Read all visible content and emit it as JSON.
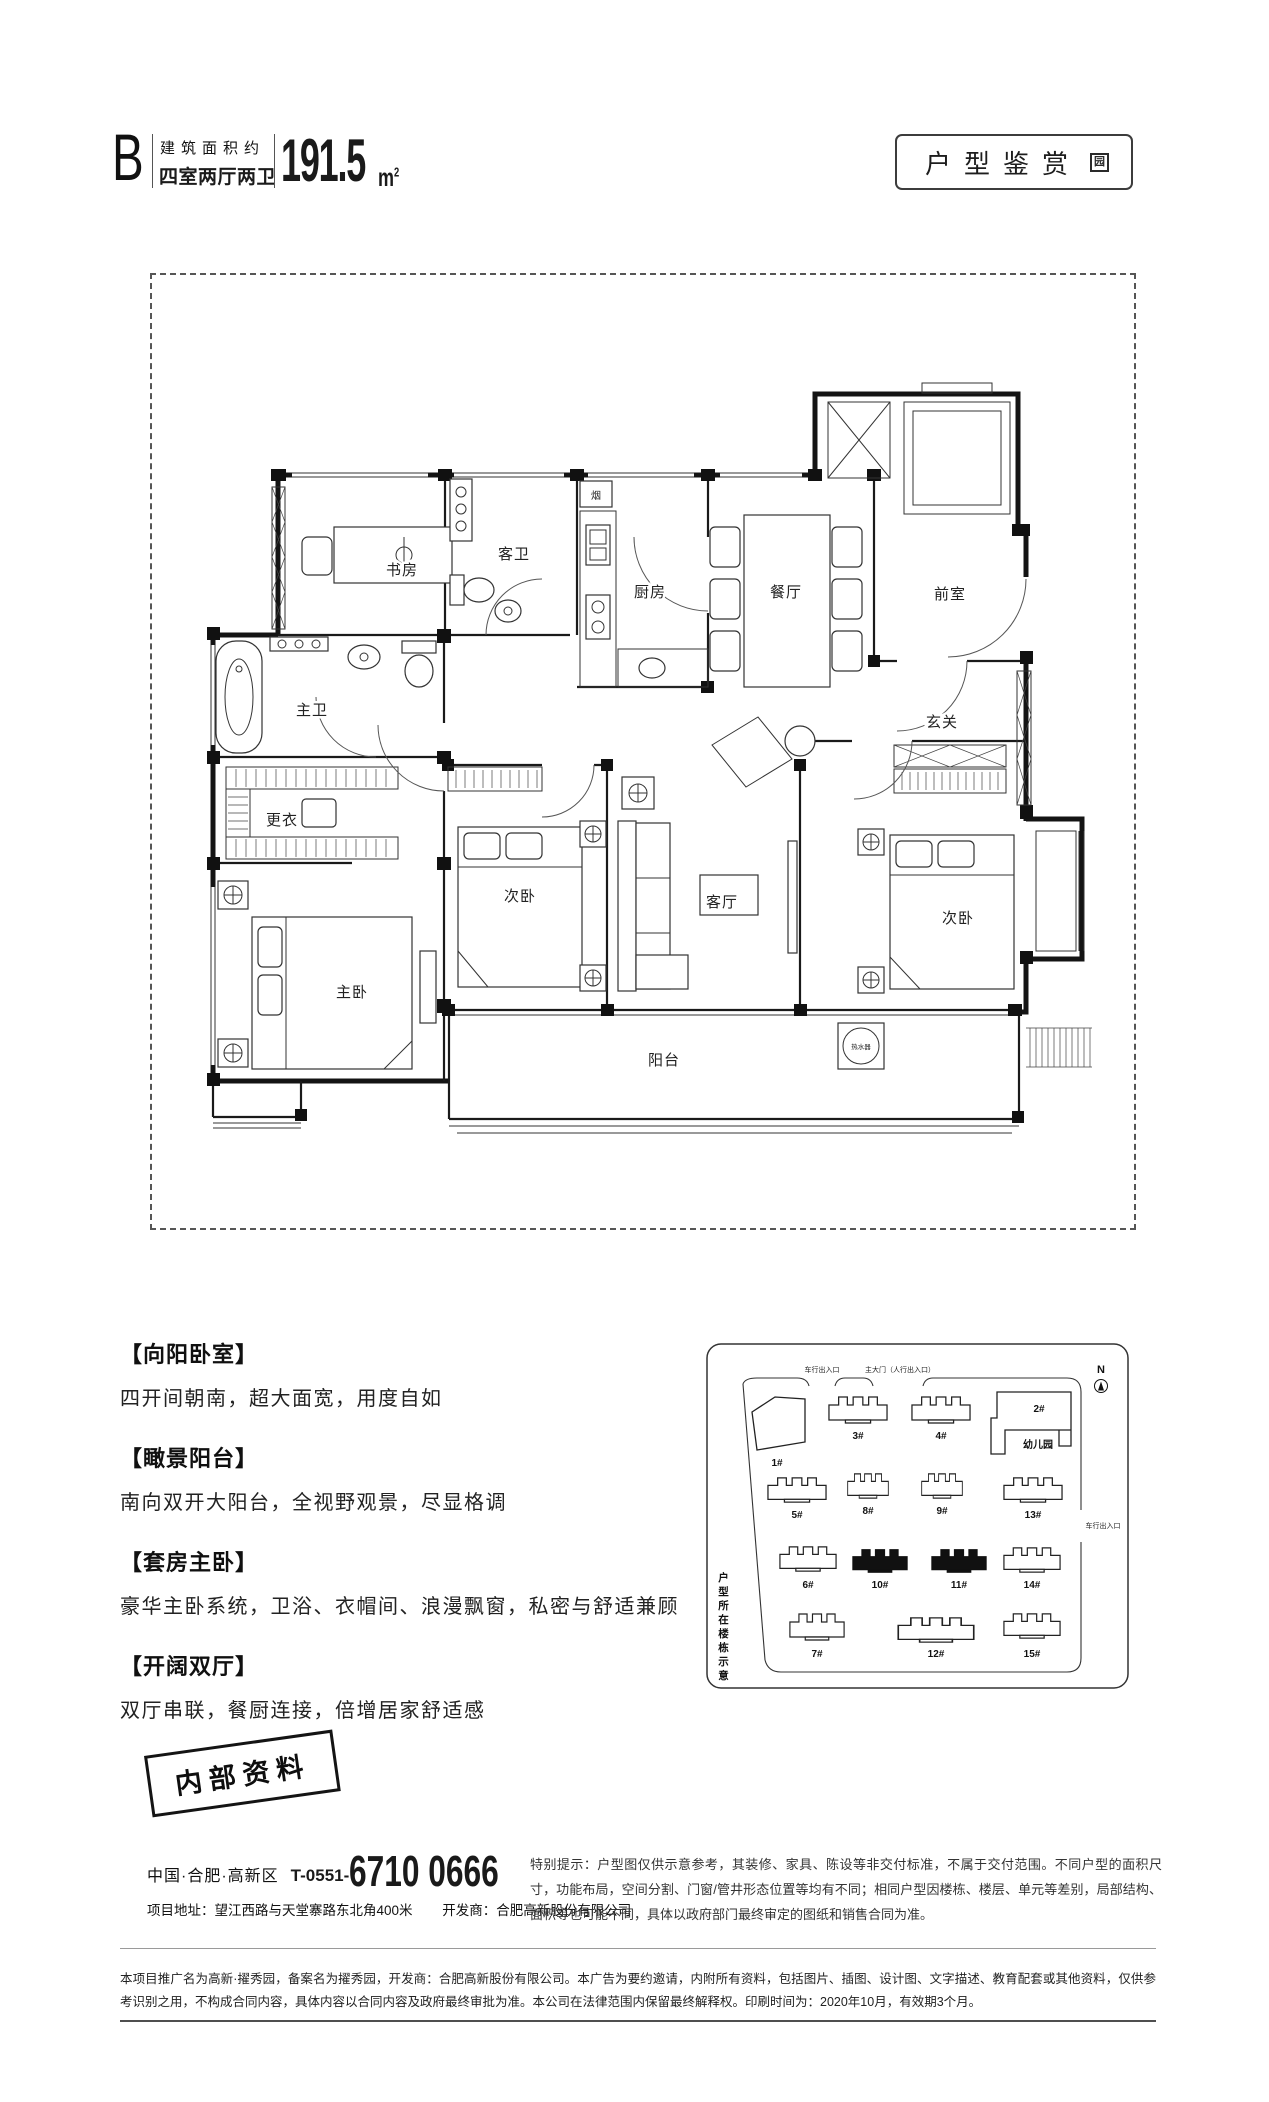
{
  "header": {
    "unit": "B",
    "area_note": "建筑面积约",
    "layout_type": "四室两厅两卫",
    "area_value": "191.5",
    "area_unit": "m",
    "area_sup": "2"
  },
  "badge": {
    "label": "户型鉴赏",
    "seal": "园"
  },
  "floorplan": {
    "rooms": {
      "study": "书房",
      "guest_bath": "客卫",
      "kitchen": "厨房",
      "dining": "餐厅",
      "front_room": "前室",
      "foyer": "玄关",
      "master_bath": "主卫",
      "dressing": "更衣",
      "master_bedroom": "主卧",
      "bedroom_mid": "次卧",
      "living": "客厅",
      "bedroom_right": "次卧",
      "balcony": "阳台"
    },
    "flue": "烟",
    "water_heater": "热水器"
  },
  "features": [
    {
      "title": "【向阳卧室】",
      "desc": "四开间朝南，超大面宽，用度自如"
    },
    {
      "title": "【瞰景阳台】",
      "desc": "南向双开大阳台，全视野观景，尽显格调"
    },
    {
      "title": "【套房主卧】",
      "desc": "豪华主卧系统，卫浴、衣帽间、浪漫飘窗，私密与舒适兼顾"
    },
    {
      "title": "【开阔双厅】",
      "desc": "双厅串联，餐厨连接，倍增居家舒适感"
    }
  ],
  "siteplan": {
    "side_label": "户型所在楼栋示意",
    "compass": "N",
    "entrance_car_top": "车行出入口",
    "entrance_main": "主大门（人行出入口）",
    "entrance_car_right": "车行出入口",
    "kindergarten": "幼儿园",
    "buildings": {
      "b1": "1#",
      "b2": "2#",
      "b3": "3#",
      "b4": "4#",
      "b5": "5#",
      "b6": "6#",
      "b7": "7#",
      "b8": "8#",
      "b9": "9#",
      "b10": "10#",
      "b11": "11#",
      "b12": "12#",
      "b13": "13#",
      "b14": "14#",
      "b15": "15#"
    },
    "highlighted": [
      "10#",
      "11#"
    ]
  },
  "stamp": "内部资料",
  "contact": {
    "region": "中国·合肥·高新区",
    "tel_prefix": "T-0551-",
    "tel_number": "6710 0666",
    "address": "项目地址：望江西路与天堂寨路东北角400米",
    "developer": "开发商：合肥高新股份有限公司"
  },
  "notice": "特别提示：户型图仅供示意参考，其装修、家具、陈设等非交付标准，不属于交付范围。不同户型的面积尺寸，功能布局，空间分割、门窗/管井形态位置等均有不同；相同户型因楼栋、楼层、单元等差别，局部结构、面积等也可能不同，具体以政府部门最终审定的图纸和销售合同为准。",
  "disclaimer": "本项目推广名为高新·擢秀园，备案名为擢秀园，开发商：合肥高新股份有限公司。本广告为要约邀请，内附所有资料，包括图片、插图、设计图、文字描述、教育配套或其他资料，仅供参考识别之用，不构成合同内容，具体内容以合同内容及政府最终审批为准。本公司在法律范围内保留最终解释权。印刷时间为：2020年10月，有效期3个月。"
}
